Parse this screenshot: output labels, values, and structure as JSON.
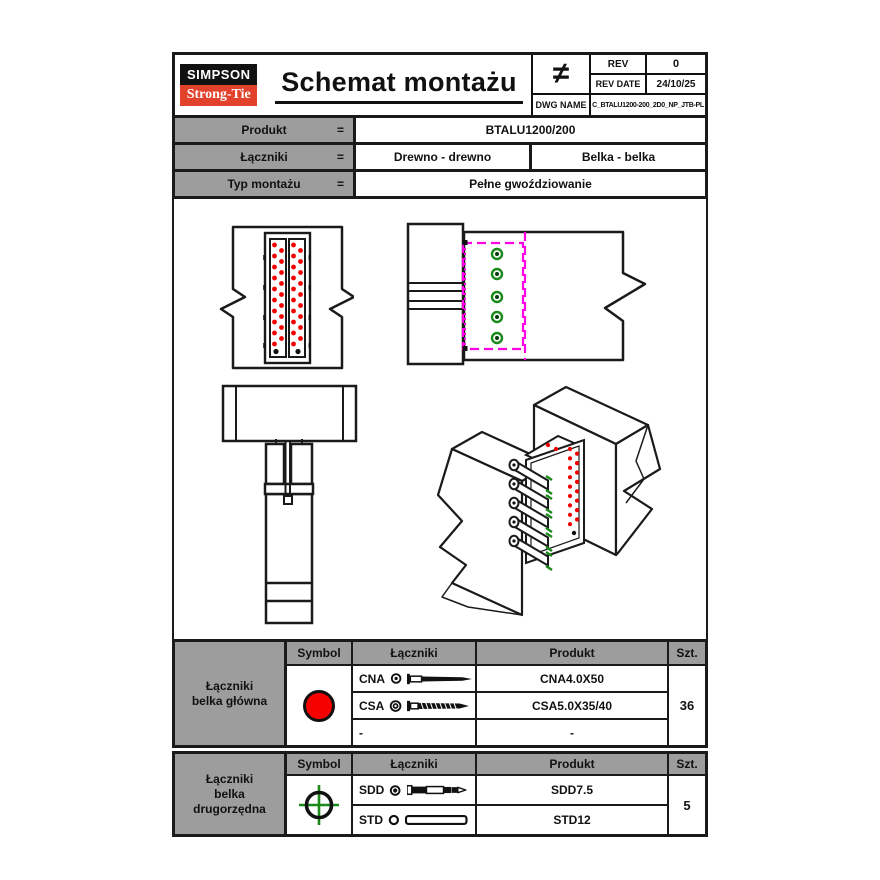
{
  "sheet": {
    "header": {
      "logo_line1": "SIMPSON",
      "logo_line2": "Strong-Tie",
      "title": "Schemat montażu",
      "not_equal_symbol": "≠",
      "rev_label": "REV",
      "rev_value": "0",
      "rev_date_label": "REV DATE",
      "rev_date_value": "24/10/25",
      "dwg_name_label": "DWG NAME",
      "dwg_name_value": "C_BTALU1200-200_2D0_NP_JTB-PL"
    },
    "product_info": {
      "eq": "=",
      "produkt_label": "Produkt",
      "produkt_value": "BTALU1200/200",
      "laczniki_label": "Łączniki",
      "laczniki_value1": "Drewno - drewno",
      "laczniki_value2": "Belka - belka",
      "typ_label": "Typ montażu",
      "typ_value": "Pełne gwoździowanie"
    },
    "table_main": {
      "group_label": "Łączniki\nbelka główna",
      "col_symbol": "Symbol",
      "col_laczniki": "Łączniki",
      "col_produkt": "Produkt",
      "col_szt": "Szt.",
      "symbol_icon": "red-filled-circle",
      "rows": [
        {
          "code": "CNA",
          "icon": "nail-icon",
          "product": "CNA4.0X50"
        },
        {
          "code": "CSA",
          "icon": "screw-icon",
          "product": "CSA5.0X35/40"
        },
        {
          "code": "-",
          "icon": "none",
          "product": "-"
        }
      ],
      "qty": "36"
    },
    "table_secondary": {
      "group_label": "Łączniki\nbelka\ndrugorzędna",
      "col_symbol": "Symbol",
      "col_laczniki": "Łączniki",
      "col_produkt": "Produkt",
      "col_szt": "Szt.",
      "symbol_icon": "green-crosshair-circle",
      "rows": [
        {
          "code": "SDD",
          "icon": "dowel-screw-icon",
          "product": "SDD7.5"
        },
        {
          "code": "STD",
          "icon": "smooth-dowel-icon",
          "product": "STD12"
        }
      ],
      "qty": "5"
    },
    "drawing_legend": {
      "nail_hole_color": "#f20000",
      "secondary_fastener_color": "#1b8a1b",
      "connector_outline_color": "#ff00e6",
      "views": "front, side, top, isometric"
    }
  }
}
